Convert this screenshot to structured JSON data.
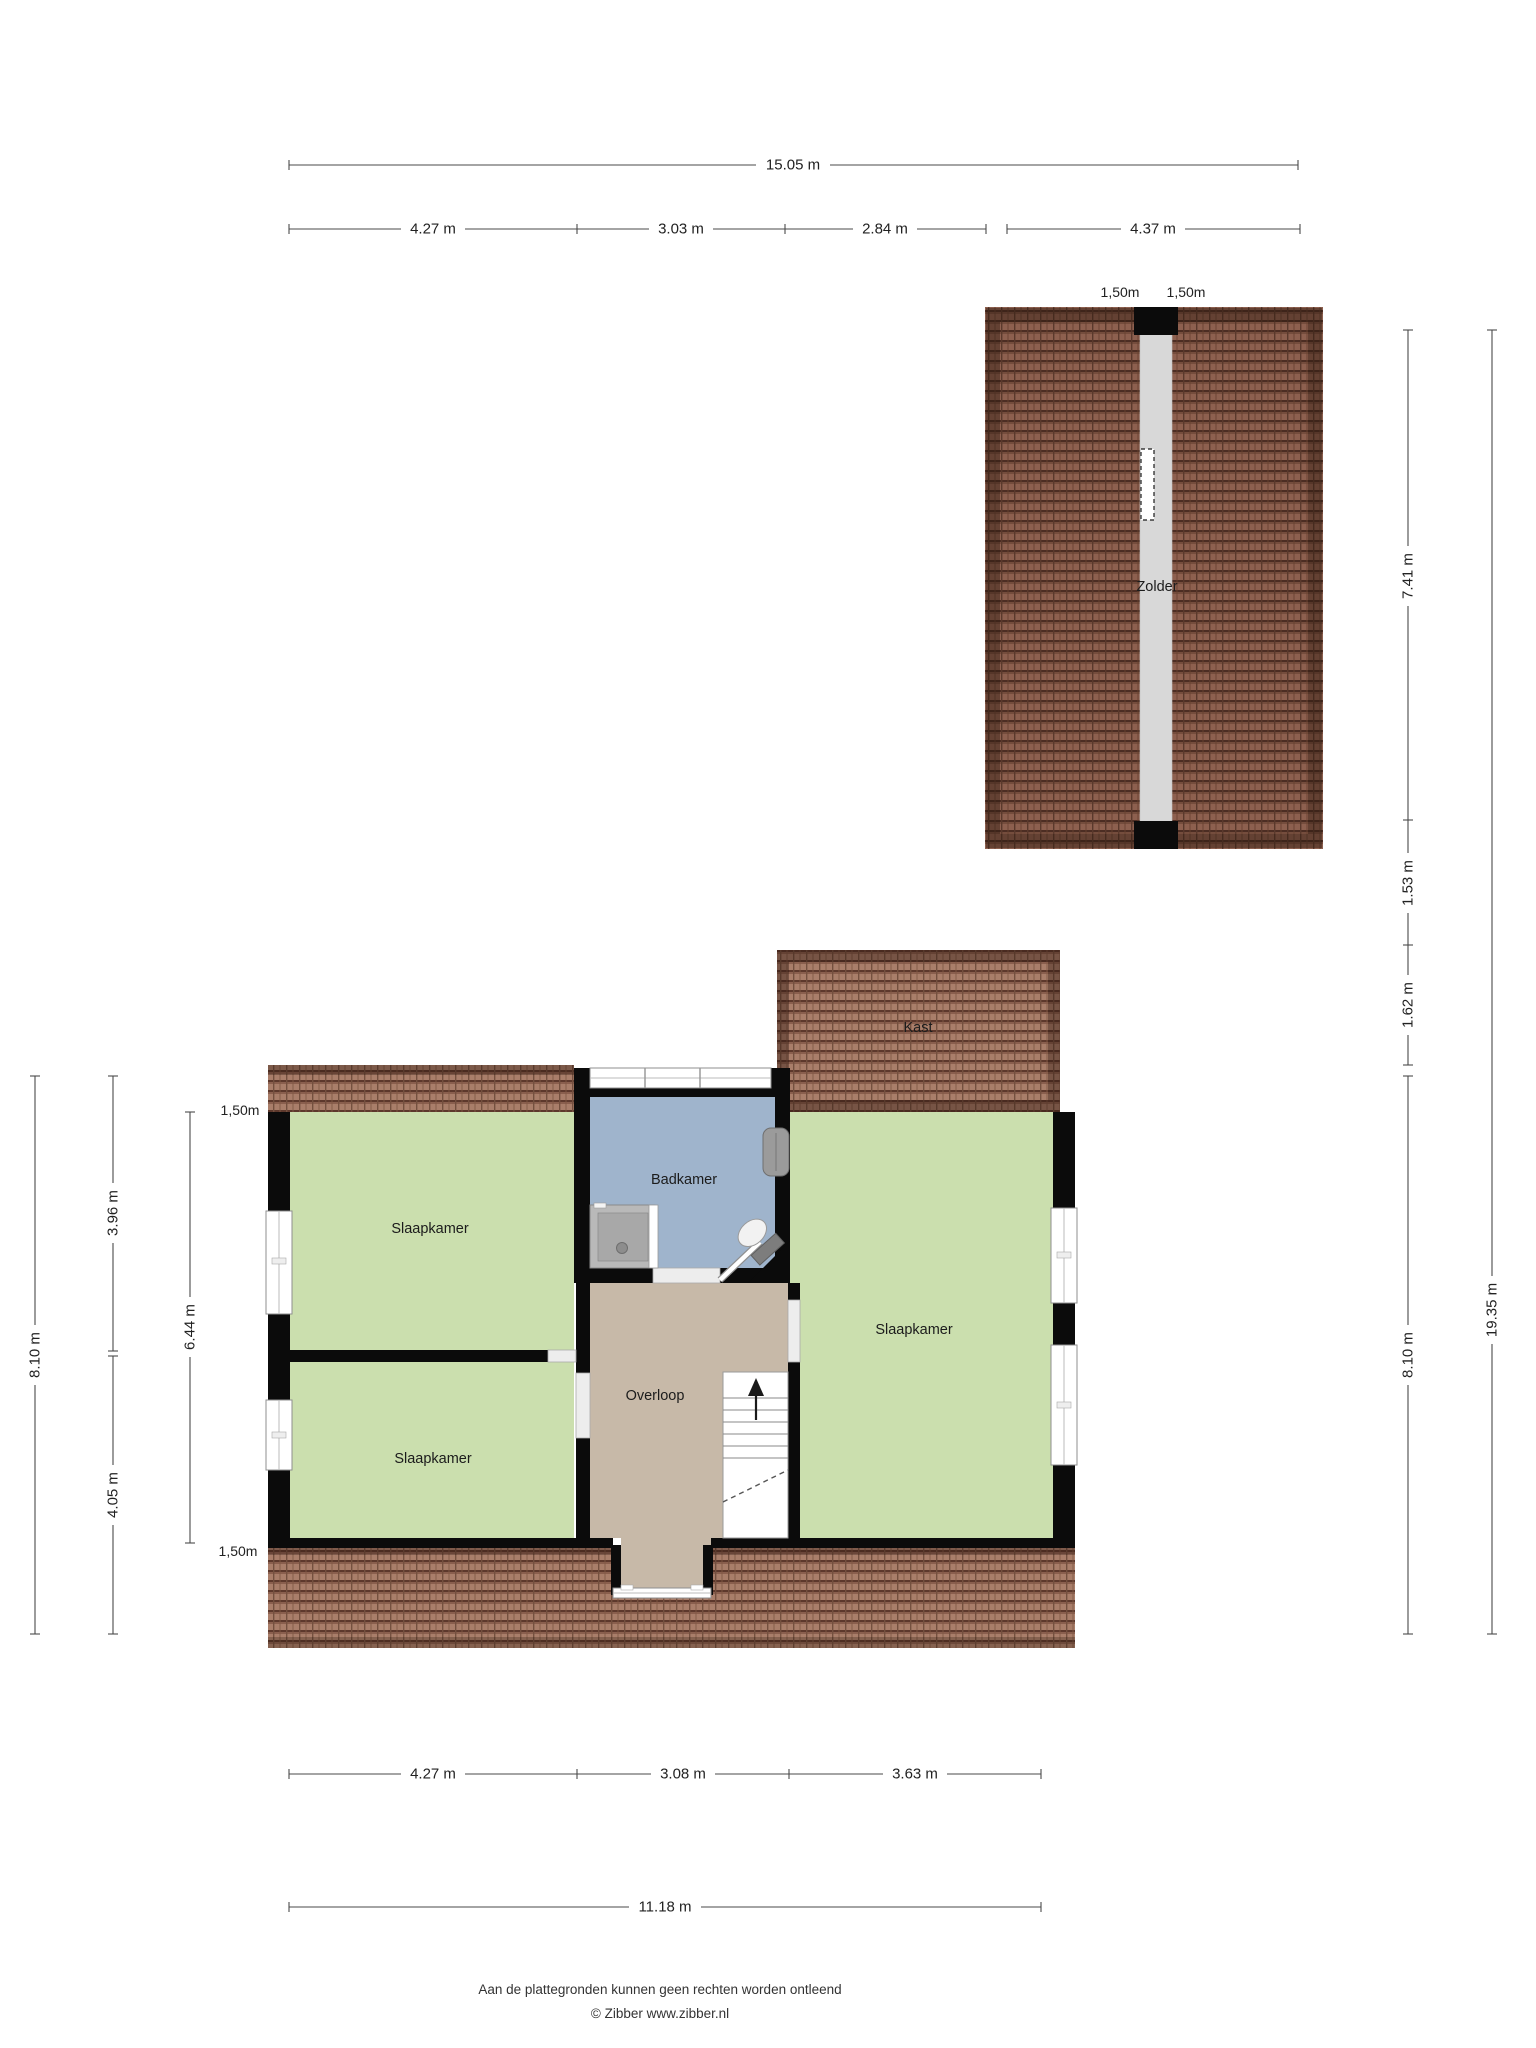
{
  "meta": {
    "doc_type": "floor-plan",
    "level_count": "2"
  },
  "rooms": {
    "zolder": "Zolder",
    "kast": "Kast",
    "badkamer": "Badkamer",
    "overloop": "Overloop",
    "slaapkamer_tl": "Slaapkamer",
    "slaapkamer_bl": "Slaapkamer",
    "slaapkamer_r": "Slaapkamer"
  },
  "dims": {
    "top": {
      "total": "15.05 m",
      "segments": [
        "4.27 m",
        "3.03 m",
        "2.84 m",
        "4.37 m"
      ]
    },
    "bottom": {
      "segments": [
        "4.27 m",
        "3.08 m",
        "3.63 m"
      ],
      "total": "11.18 m"
    },
    "left": {
      "outer": "8.10 m",
      "mid": [
        "3.96 m",
        "4.05 m"
      ],
      "inner": "6.44 m",
      "knee_top": "1,50m",
      "knee_bottom": "1,50m"
    },
    "right": {
      "inner": [
        "7.41 m",
        "1.53 m",
        "1.62 m",
        "8.10 m"
      ],
      "outer": "19.35 m"
    },
    "zolder_knee": [
      "1,50m",
      "1,50m"
    ]
  },
  "footer": {
    "line1": "Aan de plattegronden kunnen geen rechten worden ontleend",
    "line2": "© Zibber www.zibber.nl"
  },
  "colors": {
    "room_green": "#cbdfae",
    "bath_blue": "#9fb4cc",
    "hall_taupe": "#c7b9a8",
    "roof_dark_base": "#8d604f",
    "roof_light_base": "#a97e6a",
    "wall": "#0b0b0b",
    "attic_strip": "#d8d8d8"
  }
}
